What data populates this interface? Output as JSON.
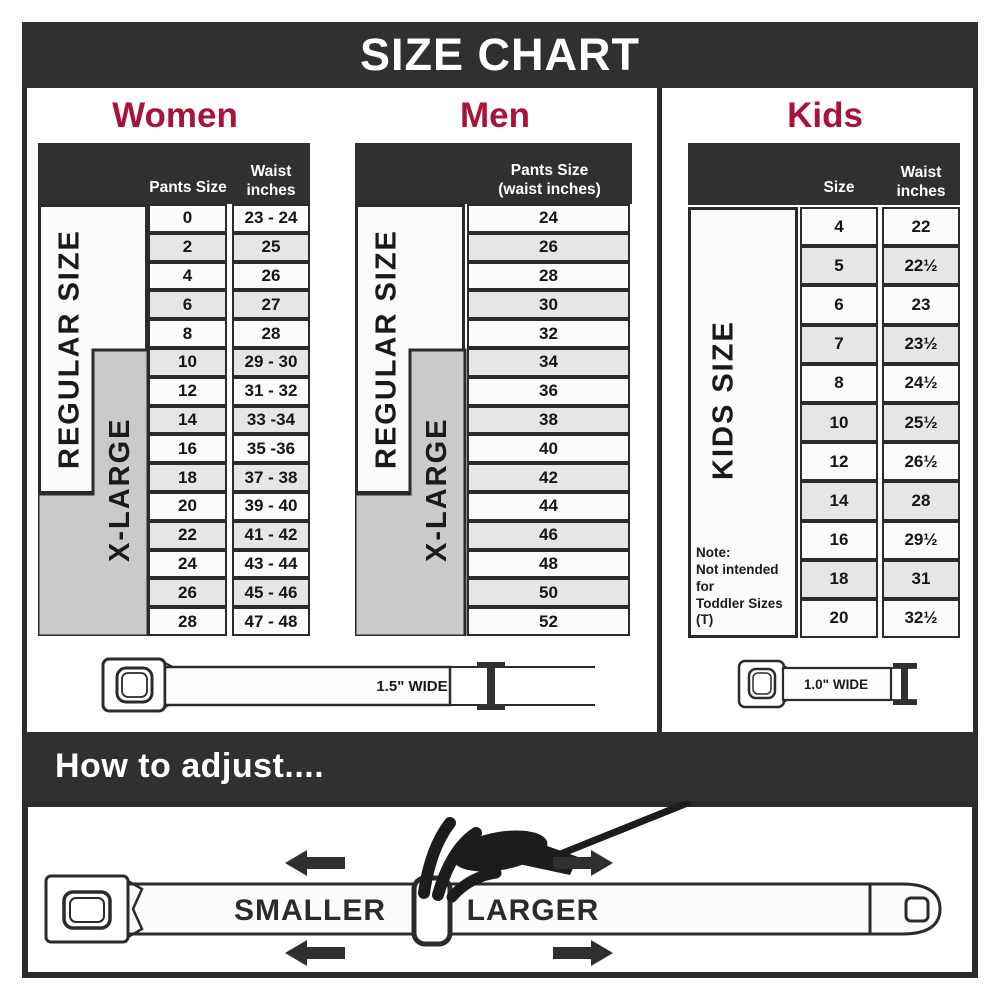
{
  "title": "SIZE CHART",
  "colors": {
    "accent_red": "#A81439",
    "dark_band": "#303030",
    "row_alt": "#e6e6e6",
    "xlarge_gray": "#cacaca"
  },
  "chart_data": [
    {
      "type": "table",
      "title": "Women",
      "columns": [
        "Pants Size",
        "Waist\ninches"
      ],
      "group_labels": [
        "REGULAR SIZE",
        "X-LARGE"
      ],
      "rows": [
        [
          "0",
          "23 - 24"
        ],
        [
          "2",
          "25"
        ],
        [
          "4",
          "26"
        ],
        [
          "6",
          "27"
        ],
        [
          "8",
          "28"
        ],
        [
          "10",
          "29 - 30"
        ],
        [
          "12",
          "31 - 32"
        ],
        [
          "14",
          "33 -34"
        ],
        [
          "16",
          "35 -36"
        ],
        [
          "18",
          "37 - 38"
        ],
        [
          "20",
          "39 - 40"
        ],
        [
          "22",
          "41 - 42"
        ],
        [
          "24",
          "43 - 44"
        ],
        [
          "26",
          "45 - 46"
        ],
        [
          "28",
          "47 - 48"
        ]
      ]
    },
    {
      "type": "table",
      "title": "Men",
      "columns": [
        "Pants Size\n(waist inches)"
      ],
      "group_labels": [
        "REGULAR SIZE",
        "X-LARGE"
      ],
      "rows": [
        [
          "24"
        ],
        [
          "26"
        ],
        [
          "28"
        ],
        [
          "30"
        ],
        [
          "32"
        ],
        [
          "34"
        ],
        [
          "36"
        ],
        [
          "38"
        ],
        [
          "40"
        ],
        [
          "42"
        ],
        [
          "44"
        ],
        [
          "46"
        ],
        [
          "48"
        ],
        [
          "50"
        ],
        [
          "52"
        ]
      ]
    },
    {
      "type": "table",
      "title": "Kids",
      "columns": [
        "Size",
        "Waist\ninches"
      ],
      "side_label": "KIDS SIZE",
      "note": "Note:\nNot intended for\nToddler Sizes (T)",
      "rows": [
        [
          "4",
          "22"
        ],
        [
          "5",
          "22½"
        ],
        [
          "6",
          "23"
        ],
        [
          "7",
          "23½"
        ],
        [
          "8",
          "24½"
        ],
        [
          "10",
          "25½"
        ],
        [
          "12",
          "26½"
        ],
        [
          "14",
          "28"
        ],
        [
          "16",
          "29½"
        ],
        [
          "18",
          "31"
        ],
        [
          "20",
          "32½"
        ]
      ]
    }
  ],
  "belts": {
    "adult_label": "1.5\" WIDE",
    "kids_label": "1.0\" WIDE"
  },
  "adjust": {
    "band_title": "How to adjust....",
    "smaller": "SMALLER",
    "larger": "LARGER"
  }
}
